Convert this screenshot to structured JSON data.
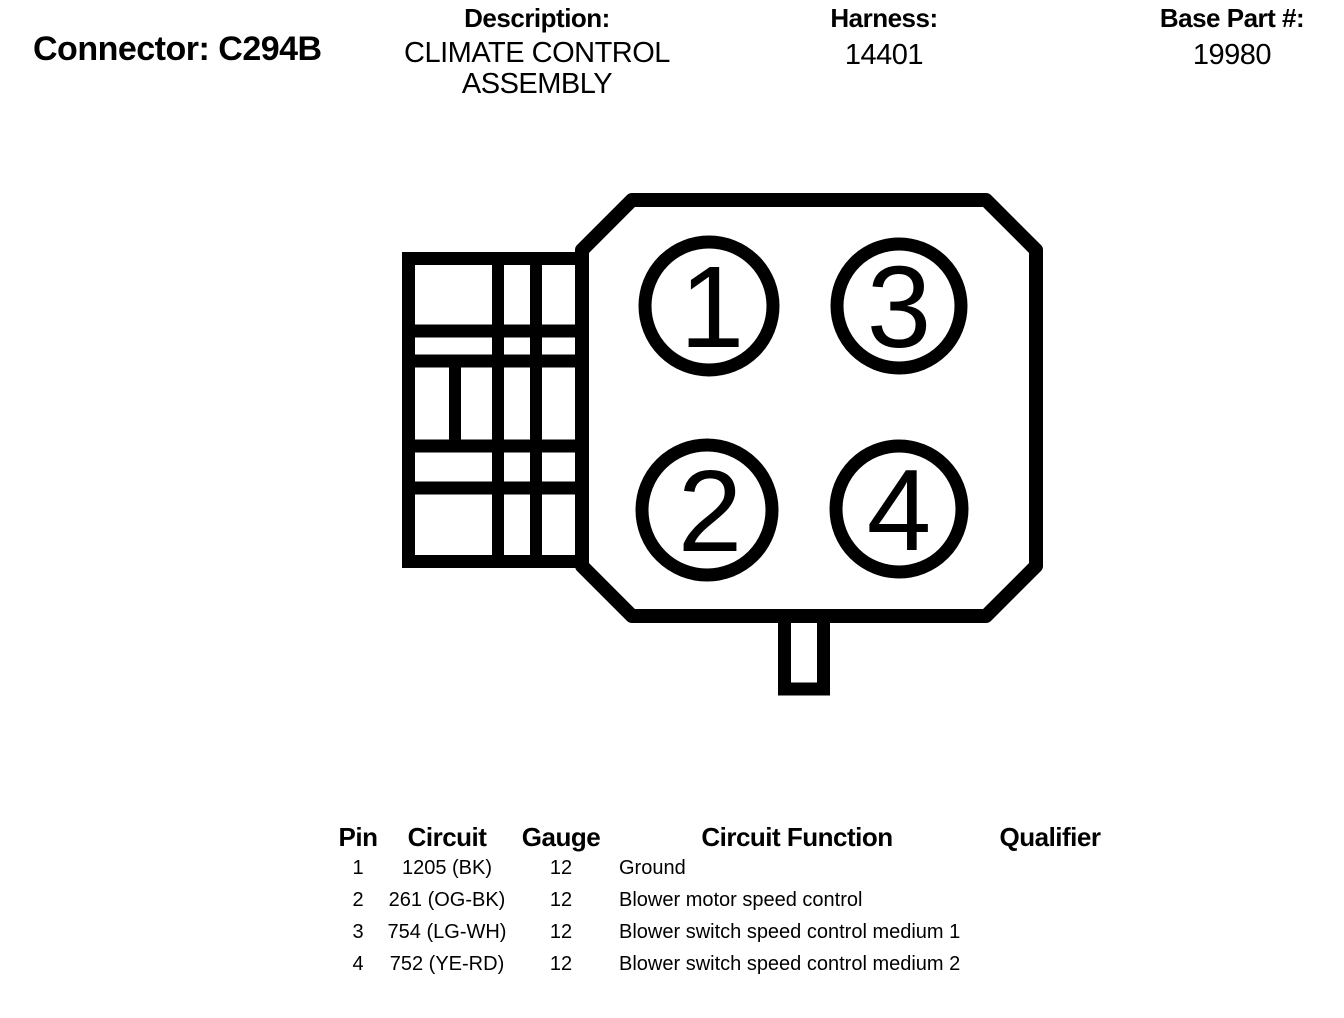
{
  "header": {
    "connector_label": "Connector: C294B",
    "description_label": "Description:",
    "description_line1": "CLIMATE CONTROL",
    "description_line2": "ASSEMBLY",
    "harness_label": "Harness:",
    "harness_value": "14401",
    "base_part_label": "Base Part #:",
    "base_part_value": "19980"
  },
  "diagram": {
    "pins": [
      {
        "label": "1"
      },
      {
        "label": "3"
      },
      {
        "label": "2"
      },
      {
        "label": "4"
      }
    ]
  },
  "table": {
    "columns": {
      "pin": "Pin",
      "circuit": "Circuit",
      "gauge": "Gauge",
      "function": "Circuit Function",
      "qualifier": "Qualifier"
    },
    "rows": [
      {
        "pin": "1",
        "circuit": "1205 (BK)",
        "gauge": "12",
        "function": "Ground",
        "qualifier": ""
      },
      {
        "pin": "2",
        "circuit": "261 (OG-BK)",
        "gauge": "12",
        "function": "Blower motor speed control",
        "qualifier": ""
      },
      {
        "pin": "3",
        "circuit": "754 (LG-WH)",
        "gauge": "12",
        "function": "Blower switch speed control medium 1",
        "qualifier": ""
      },
      {
        "pin": "4",
        "circuit": "752 (YE-RD)",
        "gauge": "12",
        "function": "Blower switch speed control medium 2",
        "qualifier": ""
      }
    ]
  },
  "colors": {
    "ink": "#000000",
    "background": "#ffffff"
  }
}
